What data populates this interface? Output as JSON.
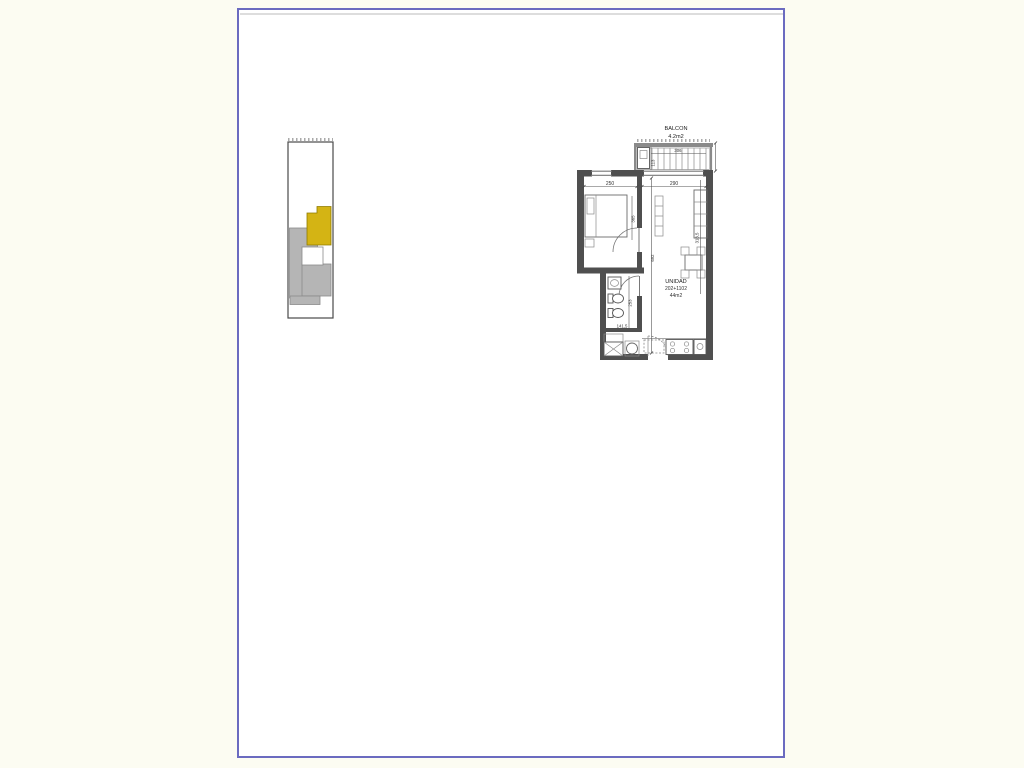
{
  "colors": {
    "canvas_bg": "#fcfcf2",
    "page_bg": "#ffffff",
    "frame_border": "#6b6bc0",
    "wall": "#4f4f4f",
    "unit_highlight": "#d4b414",
    "keyplan_gray": "#b5b5b5",
    "dim_text": "#333333"
  },
  "floor_plan": {
    "balcony_label": "BALCON",
    "balcony_area": "4.2m2",
    "unit_label": "UNIDAD",
    "unit_numbers": "202+1102",
    "unit_area": "44m2",
    "dims": {
      "bedroom_width": "250",
      "living_width": "290",
      "balcony_width": "306",
      "balcony_depth": "113",
      "bedroom_depth": "365",
      "unit_length": "692",
      "living_length": "318,5",
      "bath_depth": "253",
      "bath_width": "141,5"
    }
  }
}
